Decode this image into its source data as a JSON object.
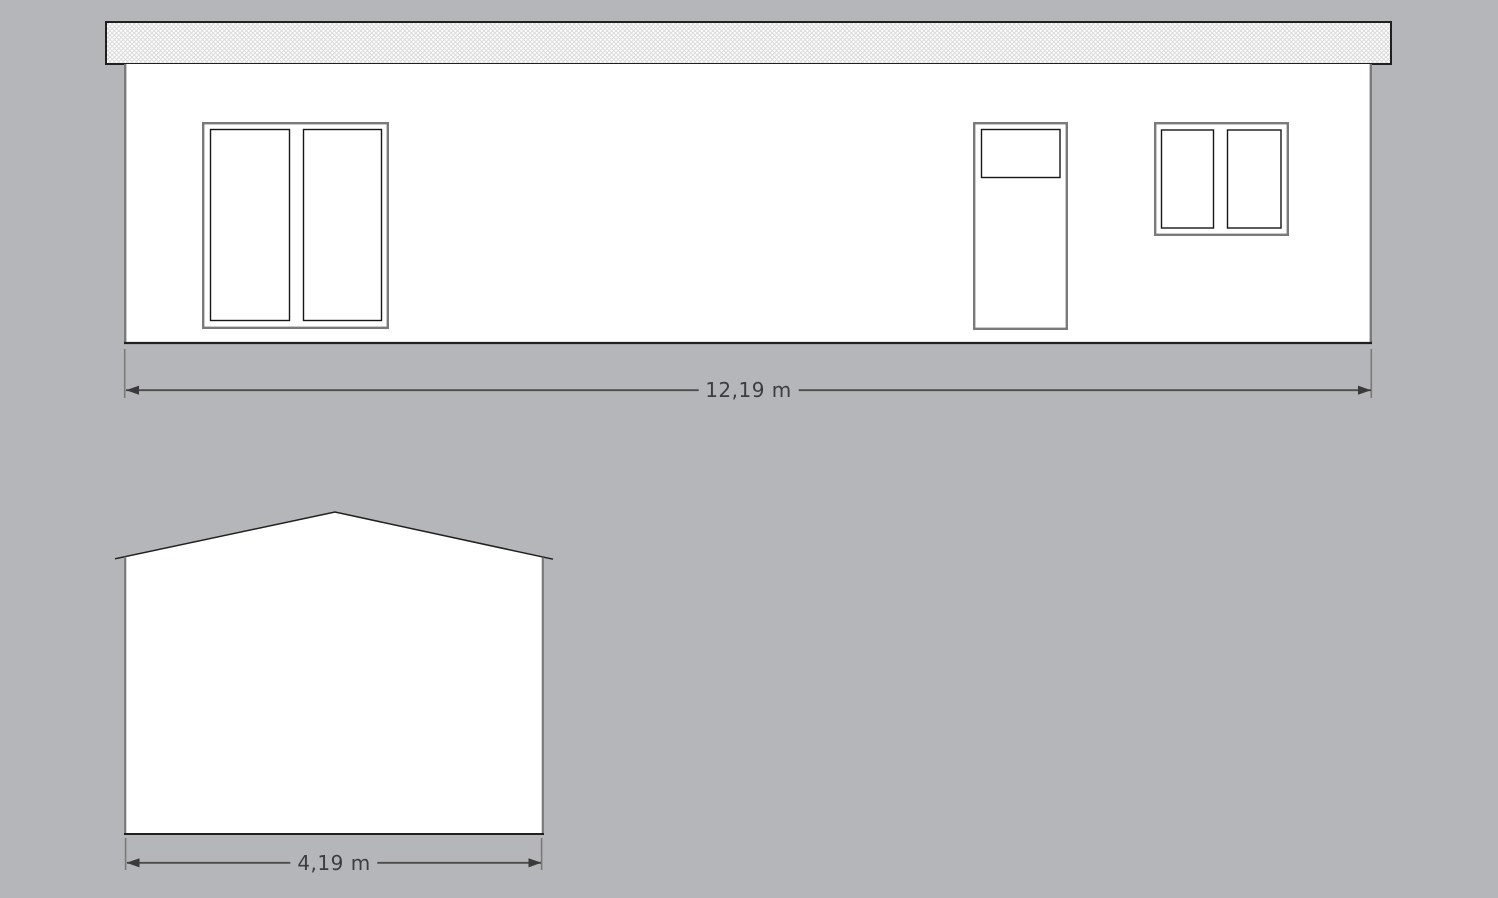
{
  "canvas": {
    "background_color": "#b5b6b9",
    "fill_color": "#ffffff",
    "outline_dark_color": "#202020",
    "outline_gray_color": "#7a7a7a",
    "dimension_line_color": "#4c4c4c",
    "dimension_text_color": "#3d3d40",
    "roof_hatch_color": "#d4d4d4"
  },
  "front_elevation": {
    "dimension_label": "12,19 m",
    "elements": [
      "roof-fascia",
      "wall",
      "double-window",
      "door-with-glass-panel",
      "double-window"
    ]
  },
  "side_elevation": {
    "dimension_label": "4,19 m",
    "elements": [
      "gable-wall",
      "pitched-roof"
    ]
  }
}
